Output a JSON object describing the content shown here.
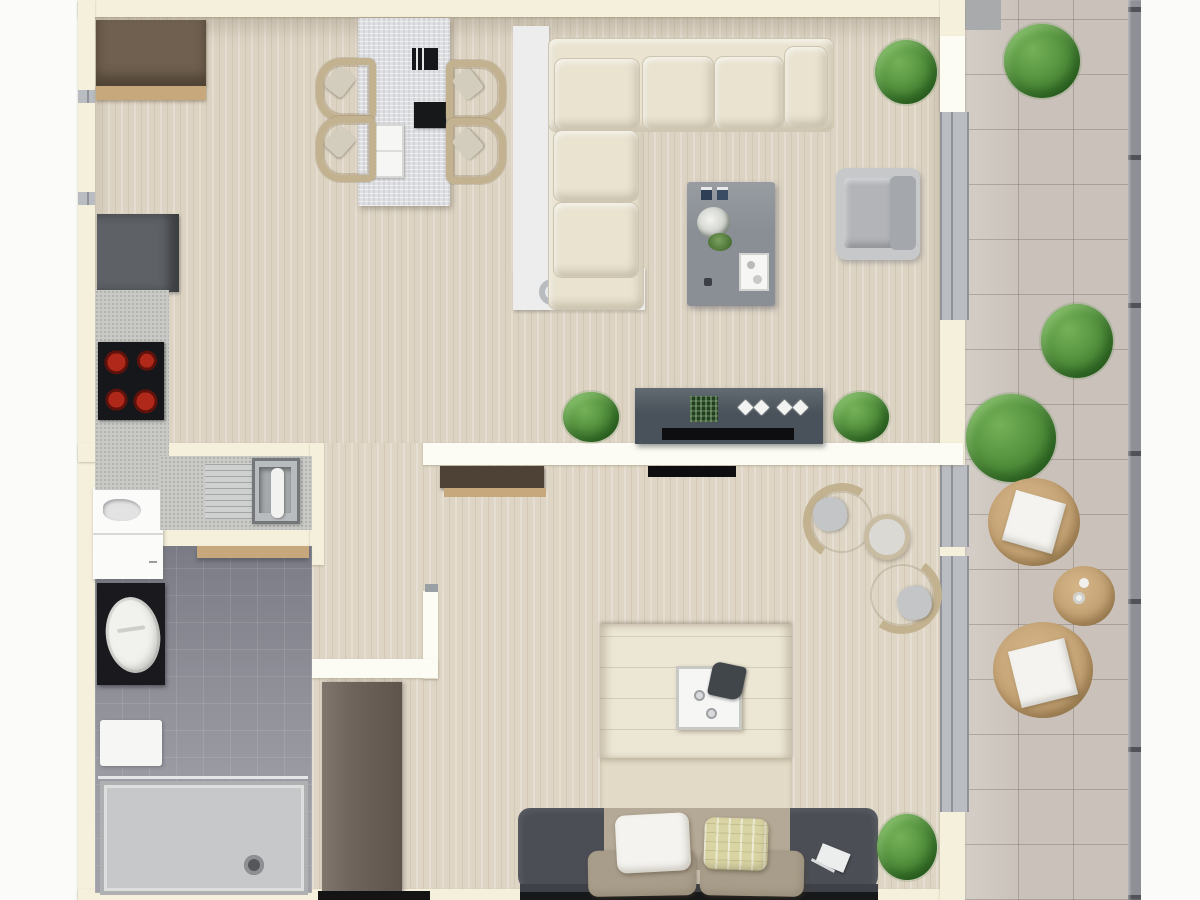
{
  "title": "apartment-floor-plan-top-view",
  "palette": {
    "bg": "#fbfbf9",
    "wall": "#f5f0db",
    "wallBright": "#fdfcf4",
    "wood": "#dcd3c3",
    "woodBed": "#ded5c5",
    "tile": "#95969e",
    "terrace": "#cac2ba",
    "glass": "#b9bcc0",
    "glassFrame": "#8f9298",
    "railing": "#8e9096",
    "sofa": "#e9e3d0",
    "platform": "#ededee",
    "marble": "#dfe0e3",
    "slate": "#8a8f95",
    "sideboard": "#49525a",
    "dark": "#16171b",
    "tvBlack": "#0e0e10",
    "fridgeBrown": "#70604f",
    "cabGray": "#5e6266",
    "counter": "#c9c9c6",
    "burner": "#a02517",
    "vanity": "#fbfbf9",
    "toiletBlack": "#1a1a1e",
    "porcelain": "#f1f1ee",
    "shower": "#c6c8c9",
    "showerEdge": "#aeb0b2",
    "wardrobe": "#6e635a",
    "woodShelf": "#c7a87c",
    "duvet": "#ece6d4",
    "duvetBand": "#e2dac6",
    "mattress": "#b4a996",
    "benchChar": "#4b4e55",
    "pillowWhite": "#f4f3ef",
    "pillowYellow": "#d9d4a4",
    "pillowTaupe": "#a89d8a",
    "green": "#4f8d3a",
    "greenDark": "#2f6b24",
    "greenLight": "#74b157",
    "tan": "#c3a173",
    "tanDark": "#a5885c",
    "wicker": "#c2b290",
    "trayWhite": "#f6f6f4"
  },
  "scene": {
    "rooms": [
      {
        "name": "kitchen",
        "items": [
          "refrigerator-cabinet",
          "wood-shelf",
          "base-cabinet",
          "countertop",
          "cooktop-4-burners",
          "drainboard",
          "sink-with-faucet"
        ]
      },
      {
        "name": "living-dining",
        "items": [
          "dining-table",
          "dining-chairs-x4",
          "black-tray",
          "laptop-tray",
          "white-tray",
          "l-shaped-sofa-5-cushions",
          "sofa-platform-rug",
          "planter-pot",
          "water-glass",
          "coffee-table",
          "candles-x2",
          "table-plant",
          "serving-tray",
          "armchair",
          "sideboard",
          "soundbar",
          "decor-diamonds-x4",
          "plant-left",
          "plant-right",
          "plant-by-sofa"
        ]
      },
      {
        "name": "bathroom",
        "items": [
          "vanity-sink",
          "wall-hung-toilet",
          "towel-rail",
          "bath-mat",
          "walk-in-shower",
          "floor-drain"
        ]
      },
      {
        "name": "hallway",
        "items": [
          "wardrobe"
        ]
      },
      {
        "name": "bedroom",
        "items": [
          "double-bed",
          "bed-tray",
          "teapot",
          "cups-x2",
          "charcoal-bench-rug",
          "wall-tv",
          "console-shelf",
          "wicker-chair-x2",
          "round-side-table",
          "white-pillow",
          "patterned-pillow",
          "taupe-pillows-x2",
          "book",
          "plant"
        ]
      },
      {
        "name": "terrace",
        "items": [
          "tile-floor",
          "railing",
          "bush-x3",
          "pouf-with-cushion-x2",
          "round-table-with-cups"
        ]
      }
    ],
    "counts": {
      "burners": 4,
      "dining_chairs": 4,
      "sofa_cushions": 5,
      "terrace_bushes": 3,
      "right_wall_windows": 3,
      "left_wall_windows": 2
    }
  }
}
